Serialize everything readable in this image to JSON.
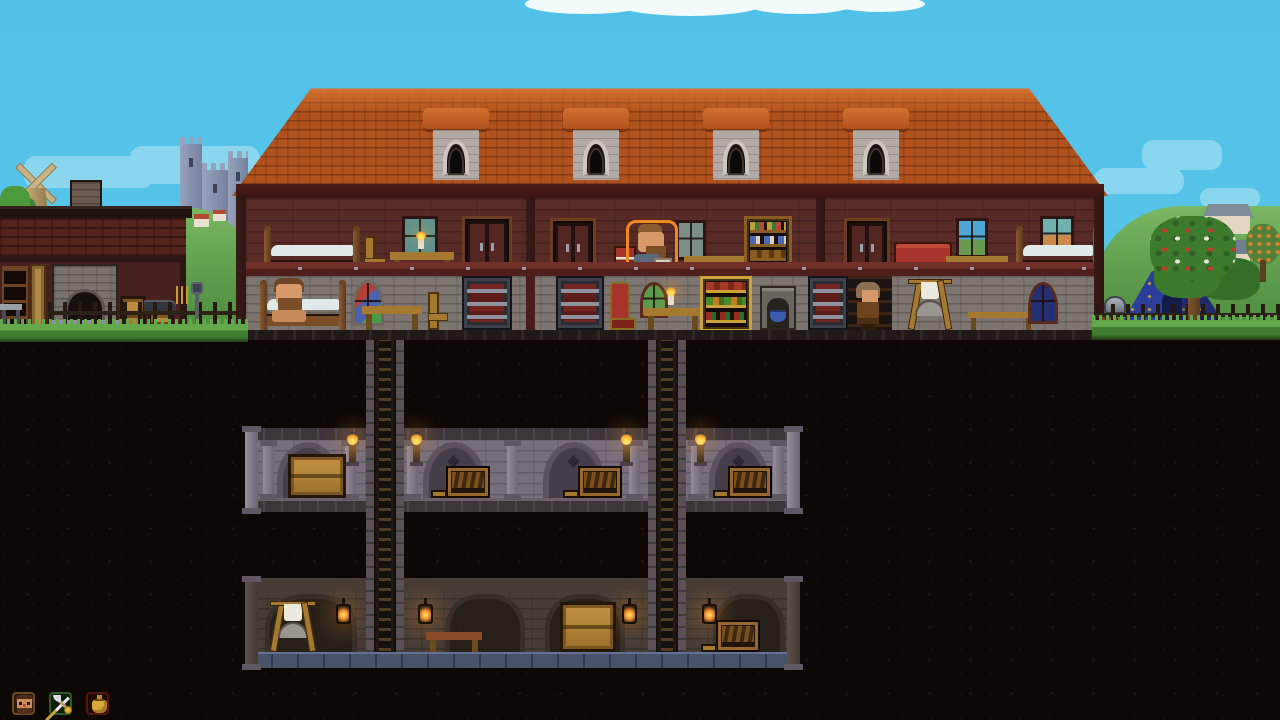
{
  "view": {
    "scene": "side-view settlement cross-section",
    "time": "day"
  },
  "hud": {
    "buttons": [
      {
        "id": "unit-portrait-button",
        "icon": "dwarf-face-icon",
        "label": "dwarf portrait"
      },
      {
        "id": "military-button",
        "icon": "crossed-axe-sword-icon",
        "label": "weapons and coin"
      },
      {
        "id": "treasury-button",
        "icon": "gold-sack-icon",
        "label": "gold sack"
      }
    ]
  },
  "background": {
    "elements": [
      "sky",
      "white-cloud-band",
      "blue-cloud-patches",
      "stone-castle",
      "windmill",
      "village-hill-left",
      "village-hill-right",
      "cottages",
      "orange-fruit-tree"
    ]
  },
  "surface": {
    "smithy": {
      "structure": "brick shed with chimney",
      "items": [
        "tool-shelf",
        "metal-workbench",
        "door-frame",
        "stone-forge",
        "crate-stack",
        "anvil-on-crate"
      ]
    },
    "manor": {
      "roof": {
        "style": "terracotta shingles",
        "dormers": 4
      },
      "upper_floor_items": [
        "bed",
        "chair",
        "desk-with-candle",
        "window",
        "wardrobe",
        "cabinet",
        "red-side-table",
        "window",
        "long-bench",
        "bookshelf",
        "cabinet",
        "red-sofa",
        "window",
        "low-table",
        "bed",
        "window"
      ],
      "ground_floor_items": [
        "occupied-bed",
        "stained-glass-window",
        "table",
        "chair",
        "iron-door",
        "iron-door",
        "red-throne",
        "round-green-window",
        "table-with-candle",
        "pantry-shelf",
        "hearth-with-blue-cauldron",
        "open-iron-door",
        "tanning-rack",
        "bench",
        "dark-blue-window"
      ]
    },
    "camp": [
      "blue-tent-with-gold-lilies",
      "blossoming-apple-tree",
      "fence-with-pink-flowers",
      "lamppost",
      "metal-pot",
      "supply-sacks"
    ]
  },
  "underground": {
    "ladder_shafts": 2,
    "cellar_level": {
      "style": "arched stone vaults",
      "lighting": "wall-torches",
      "items": [
        "large-crate",
        "open-supply-crate",
        "open-supply-crate",
        "open-supply-crate"
      ]
    },
    "dungeon_level": {
      "style": "dark brick rooms on blue stone floor",
      "lighting": "hanging-lanterns",
      "items": [
        "tanning-rack",
        "wooden-table",
        "large-crate",
        "open-supply-crate"
      ]
    }
  },
  "characters": [
    {
      "id": "dwarf-reading",
      "location": "manor-upper-floor-middle-room",
      "pose": "sitting-reading",
      "selected": true
    },
    {
      "id": "dwarf-in-bed",
      "location": "manor-ground-floor-left-room",
      "pose": "sitting-in-bed",
      "selected": false
    },
    {
      "id": "hooded-villager",
      "location": "manor-ground-floor-right-room",
      "pose": "standing-by-open-door",
      "selected": false
    }
  ],
  "palette": {
    "sky": "#51c1e8",
    "cloud_blue": "#8bd6ef",
    "cloud_white": "#f2fafc",
    "castle": "#97a3bd",
    "castle_dark": "#76829e",
    "hill": "#7ab863",
    "hill_dark": "#4d8a3e",
    "grass_light": "#63a94b",
    "grass_shadow": "#1e3a17",
    "roof": "#b0521d",
    "roof_light": "#d27030",
    "roof_trim": "#3a1512",
    "wall_wood": "#582b27",
    "beam": "#71302c",
    "beam_dark": "#4f1f1c",
    "trim": "#2f1513",
    "stone": "#7d7570",
    "dormer_stone": "#b3aaa5",
    "window_frame": "#2c1513",
    "glass_teal": "#5d928f",
    "glass_night": "#232f72",
    "glass_green": "#5a9a4a",
    "glass_stained_red": "#b04038",
    "glass_stained_blue": "#4a62b0",
    "wood": "#a5792f",
    "wood_dark": "#6b4a1e",
    "sheet": "#dfe9e9",
    "red_fabric": "#a8332b",
    "iron": "#33343c",
    "iron_panel": "#752621",
    "skin": "#d7996a",
    "hair": "#6e4526",
    "flame": "#f6a32c",
    "cellar": "#776e7c",
    "cellar_arch": "#5b525e",
    "cellar_dark": "#453e48",
    "cellar_edge": "#3c353c",
    "dungeon": "#473d36",
    "dungeon_arch": "#362e29",
    "dungeon_dark": "#262019",
    "dungeon_floor": "#48526a",
    "dungeon_floor_lip": "#657194",
    "soil": "#0d0806",
    "shaft_stone": "#5a5156",
    "ladder_wood": "#523c26",
    "tent": "#2c3d9a",
    "gold": "#c9a23a",
    "crate": "#b5873a",
    "crate_line": "#241708",
    "brick": "#55231e",
    "smithy_inner": "#46211e",
    "smithy_roof": "#1c1210",
    "selection": "#f08a1e",
    "hud_border": "#0d0a05"
  }
}
